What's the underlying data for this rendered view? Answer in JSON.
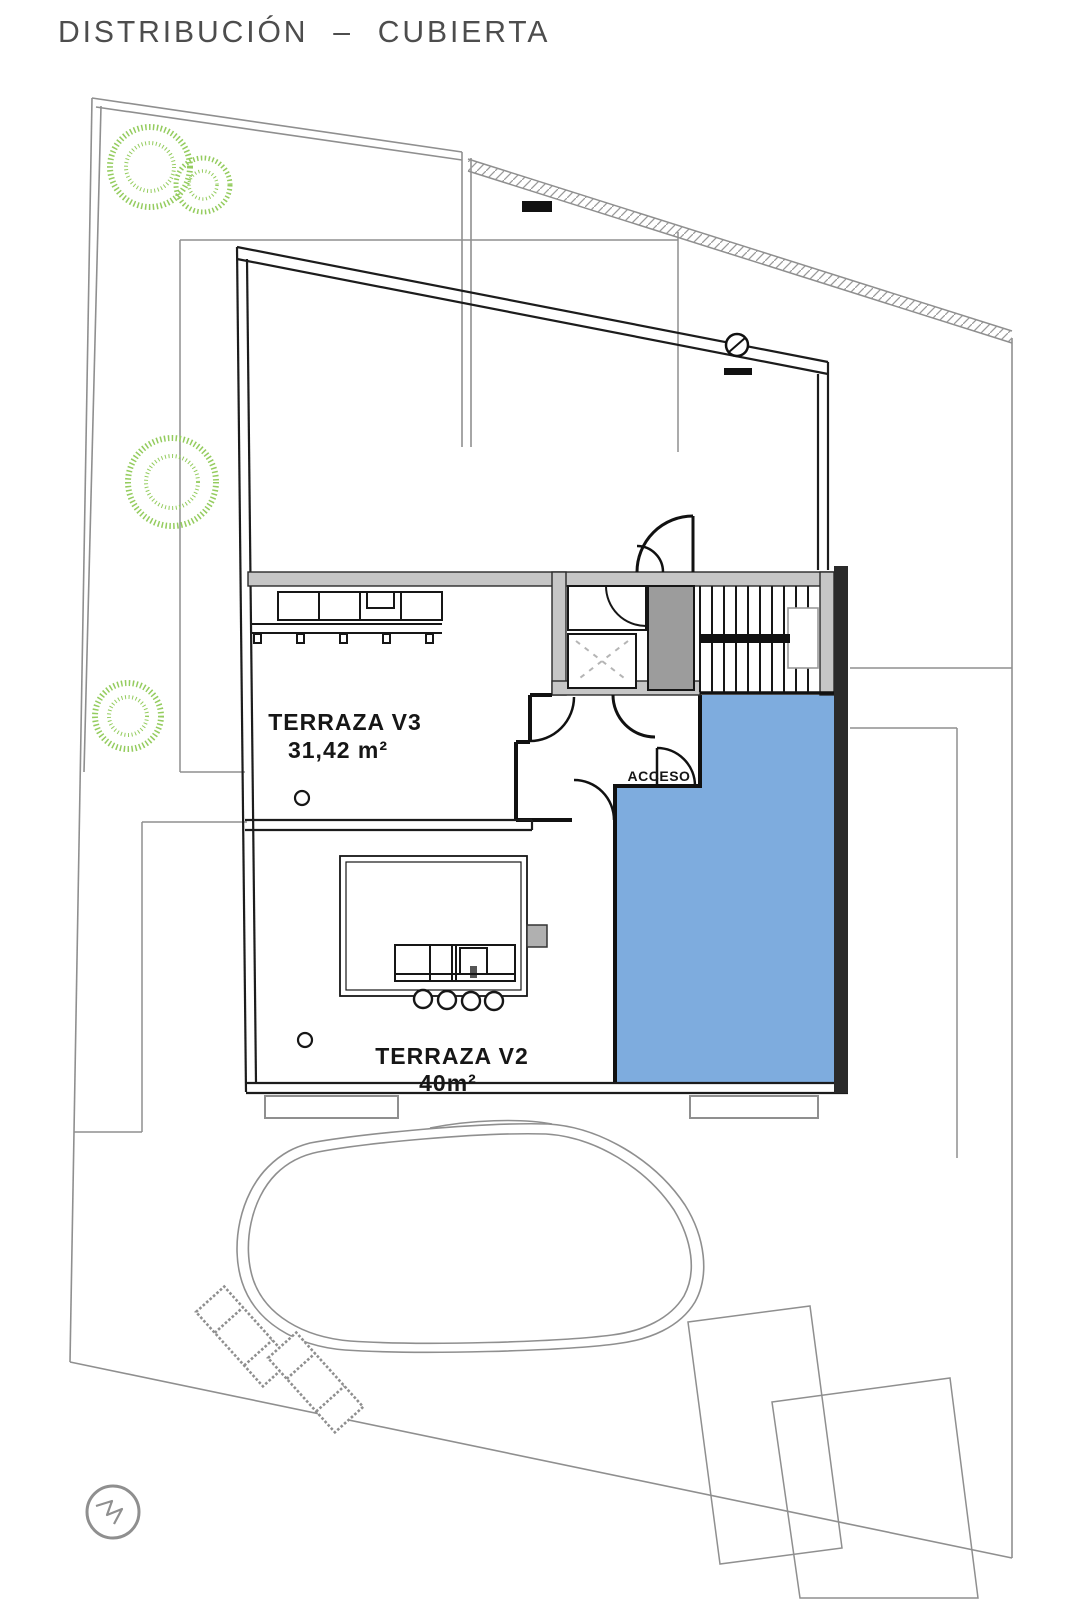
{
  "title": "DISTRIBUCIÓN – CUBIERTA",
  "rooms": {
    "terraza_v3": {
      "label": "TERRAZA V3",
      "area": "31,42 m²"
    },
    "terraza_v2": {
      "label": "TERRAZA V2",
      "area": "40m²"
    }
  },
  "annotations": {
    "acceso": "ACCESO"
  },
  "colors": {
    "roof_highlight": "#7EACDE",
    "vegetation": "#94CC5E",
    "wall": "#1C1C1C",
    "site_line": "#8F8F8F"
  }
}
